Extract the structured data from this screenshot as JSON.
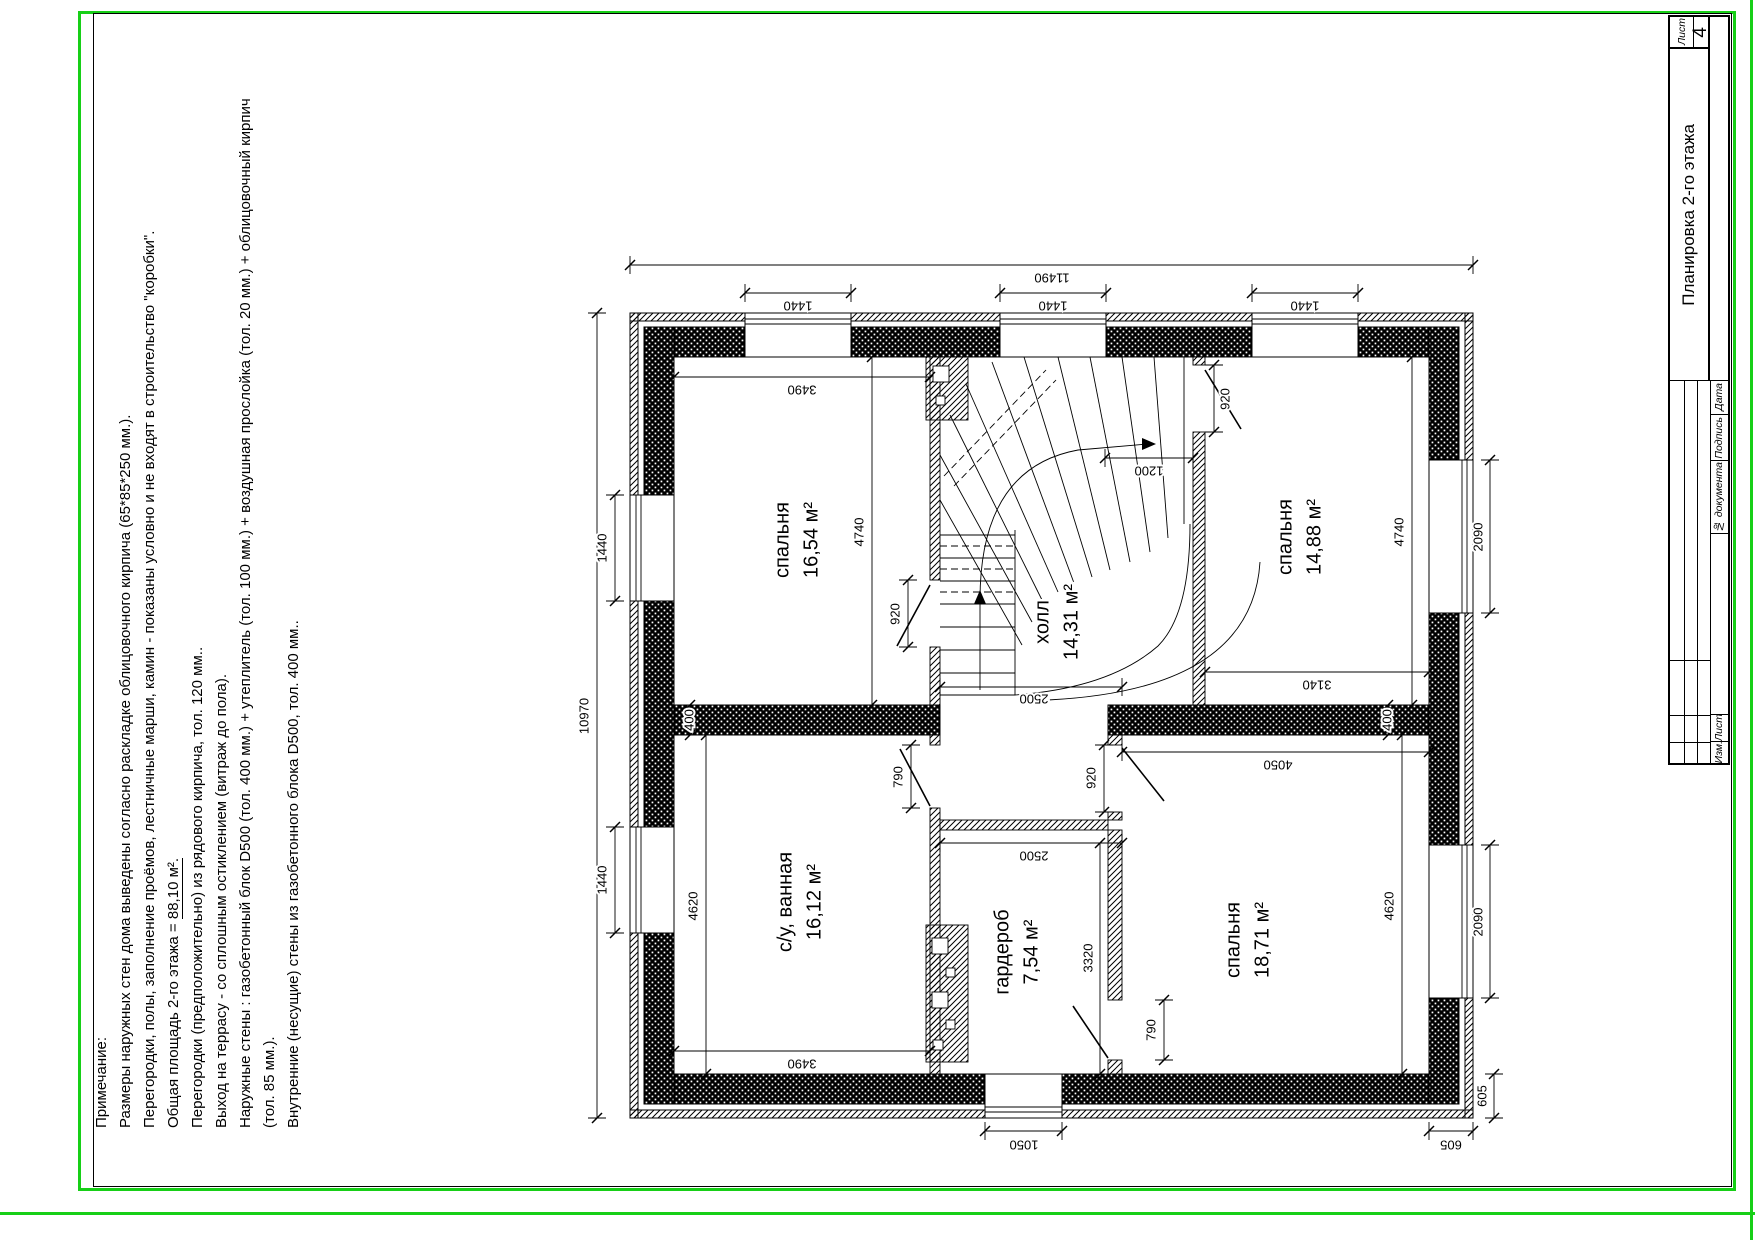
{
  "sheet": {
    "frame_color": "#17cf17",
    "stamp": {
      "title": "Планировка 2-го этажа",
      "sheet_label": "Лист",
      "sheet_number": "4",
      "col_izm": "Изм.",
      "col_list": "Лист",
      "col_doc": "№ документа",
      "col_sign": "Подпись",
      "col_date": "Дата"
    },
    "notes": {
      "heading": "Примечание:",
      "line2": "Размеры наружных стен дома выведены согласно раскладке облицовочного кирпича (65*85*250 мм.).",
      "line3": "Перегородки, полы, заполнение проёмов, лестничные марши, камин - показаны условно и не входят в строительство \"коробки\".",
      "line4_prefix": "Общая площадь 2-го этажа = ",
      "line4_value": "88,10 м².",
      "line5": "Перегородки (предположительно) из рядового кирпича, тол. 120 мм..",
      "line6": "Выход на террасу - со сплошным остиклением (витраж до пола).",
      "line7": "Наружные стены : газобетонный блок  D500 (тол. 400 мм.) + утеплитель (тол. 100 мм.) + воздушная прослойка (тол. 20 мм.) + облицовочный кирпич (тол. 85 мм.).",
      "line8": "Внутренние (несущие) стены из газобетонного блока  D500, тол. 400 мм.."
    }
  },
  "plan": {
    "rooms": [
      {
        "name": "спальня",
        "area": "16,54 м²",
        "cx": 797,
        "cy": 540
      },
      {
        "name": "спальня",
        "area": "14,88 м²",
        "cx": 1300,
        "cy": 537
      },
      {
        "name": "холл",
        "area": "14,31 м²",
        "cx": 1057,
        "cy": 622
      },
      {
        "name": "с/у, ванная",
        "area": "16,12 м²",
        "cx": 800,
        "cy": 902
      },
      {
        "name": "гардероб",
        "area": "7,54 м²",
        "cx": 1017,
        "cy": 952
      },
      {
        "name": "спальня",
        "area": "18,71 м²",
        "cx": 1248,
        "cy": 940
      }
    ],
    "dims": [
      {
        "t": "11490",
        "x1": 630,
        "y1": 265,
        "x2": 1473,
        "y2": 265,
        "tx": 1052,
        "ty": 277,
        "rot": 180
      },
      {
        "t": "1440",
        "x1": 745,
        "y1": 293,
        "x2": 851,
        "y2": 293,
        "tx": 798,
        "ty": 305,
        "rot": 180
      },
      {
        "t": "1440",
        "x1": 1000,
        "y1": 293,
        "x2": 1106,
        "y2": 293,
        "tx": 1053,
        "ty": 305,
        "rot": 180
      },
      {
        "t": "1440",
        "x1": 1252,
        "y1": 293,
        "x2": 1358,
        "y2": 293,
        "tx": 1305,
        "ty": 305,
        "rot": 180
      },
      {
        "t": "10970",
        "x1": 597,
        "y1": 313,
        "x2": 597,
        "y2": 1118,
        "tx": 585,
        "ty": 716,
        "rot": -90
      },
      {
        "t": "1440",
        "x1": 615,
        "y1": 495,
        "x2": 615,
        "y2": 601,
        "tx": 603,
        "ty": 548,
        "rot": -90
      },
      {
        "t": "1440",
        "x1": 615,
        "y1": 827,
        "x2": 615,
        "y2": 933,
        "tx": 603,
        "ty": 880,
        "rot": -90
      },
      {
        "t": "2090",
        "x1": 1490,
        "y1": 460,
        "x2": 1490,
        "y2": 613,
        "tx": 1479,
        "ty": 537,
        "rot": -90
      },
      {
        "t": "2090",
        "x1": 1490,
        "y1": 845,
        "x2": 1490,
        "y2": 998,
        "tx": 1479,
        "ty": 922,
        "rot": -90
      },
      {
        "t": "605",
        "x1": 1494,
        "y1": 1074,
        "x2": 1494,
        "y2": 1118,
        "tx": 1483,
        "ty": 1096,
        "rot": -90
      },
      {
        "t": "1050",
        "x1": 985,
        "y1": 1131,
        "x2": 1062,
        "y2": 1131,
        "tx": 1024,
        "ty": 1144,
        "rot": 180
      },
      {
        "t": "605",
        "x1": 1429,
        "y1": 1131,
        "x2": 1473,
        "y2": 1131,
        "tx": 1451,
        "ty": 1144,
        "rot": 180
      },
      {
        "t": "3490",
        "x1": 674,
        "y1": 377,
        "x2": 930,
        "y2": 377,
        "tx": 802,
        "ty": 389,
        "rot": 180
      },
      {
        "t": "4740",
        "x1": 872,
        "y1": 357,
        "x2": 872,
        "y2": 705,
        "tx": 860,
        "ty": 532,
        "rot": -90
      },
      {
        "t": "920",
        "x1": 908,
        "y1": 580,
        "x2": 908,
        "y2": 647,
        "tx": 896,
        "ty": 614,
        "rot": -90
      },
      {
        "t": "1200",
        "x1": 1105,
        "y1": 458,
        "x2": 1193,
        "y2": 458,
        "tx": 1149,
        "ty": 470,
        "rot": 180
      },
      {
        "t": "920",
        "x1": 1214,
        "y1": 365,
        "x2": 1214,
        "y2": 432,
        "tx": 1226,
        "ty": 399,
        "rot": -90
      },
      {
        "t": "4740",
        "x1": 1412,
        "y1": 357,
        "x2": 1412,
        "y2": 705,
        "tx": 1400,
        "ty": 532,
        "rot": -90
      },
      {
        "t": "3140",
        "x1": 1205,
        "y1": 672,
        "x2": 1429,
        "y2": 672,
        "tx": 1317,
        "ty": 684,
        "rot": 180
      },
      {
        "t": "400",
        "x1": 690,
        "y1": 705,
        "x2": 690,
        "y2": 735,
        "tx": 690,
        "ty": 720,
        "rot": -90
      },
      {
        "t": "400",
        "x1": 1388,
        "y1": 705,
        "x2": 1388,
        "y2": 735,
        "tx": 1388,
        "ty": 720,
        "rot": -90
      },
      {
        "t": "4050",
        "x1": 1122,
        "y1": 752,
        "x2": 1429,
        "y2": 752,
        "tx": 1278,
        "ty": 764,
        "rot": 180
      },
      {
        "t": "2500",
        "x1": 940,
        "y1": 687,
        "x2": 1122,
        "y2": 687,
        "tx": 1034,
        "ty": 698,
        "rot": 180
      },
      {
        "t": "2500",
        "x1": 940,
        "y1": 843,
        "x2": 1122,
        "y2": 843,
        "tx": 1034,
        "ty": 855,
        "rot": 180
      },
      {
        "t": "3320",
        "x1": 1100,
        "y1": 843,
        "x2": 1100,
        "y2": 1074,
        "tx": 1089,
        "ty": 958,
        "rot": -90
      },
      {
        "t": "790",
        "x1": 911,
        "y1": 745,
        "x2": 911,
        "y2": 808,
        "tx": 899,
        "ty": 777,
        "rot": -90
      },
      {
        "t": "920",
        "x1": 1104,
        "y1": 745,
        "x2": 1104,
        "y2": 812,
        "tx": 1092,
        "ty": 778,
        "rot": -90
      },
      {
        "t": "790",
        "x1": 1164,
        "y1": 1000,
        "x2": 1164,
        "y2": 1060,
        "tx": 1152,
        "ty": 1030,
        "rot": -90
      },
      {
        "t": "3490",
        "x1": 674,
        "y1": 1051,
        "x2": 930,
        "y2": 1051,
        "tx": 802,
        "ty": 1063,
        "rot": 180
      },
      {
        "t": "4620",
        "x1": 706,
        "y1": 735,
        "x2": 706,
        "y2": 1074,
        "tx": 694,
        "ty": 906,
        "rot": -90
      },
      {
        "t": "4620",
        "x1": 1402,
        "y1": 735,
        "x2": 1402,
        "y2": 1074,
        "tx": 1390,
        "ty": 906,
        "rot": -90
      }
    ]
  }
}
